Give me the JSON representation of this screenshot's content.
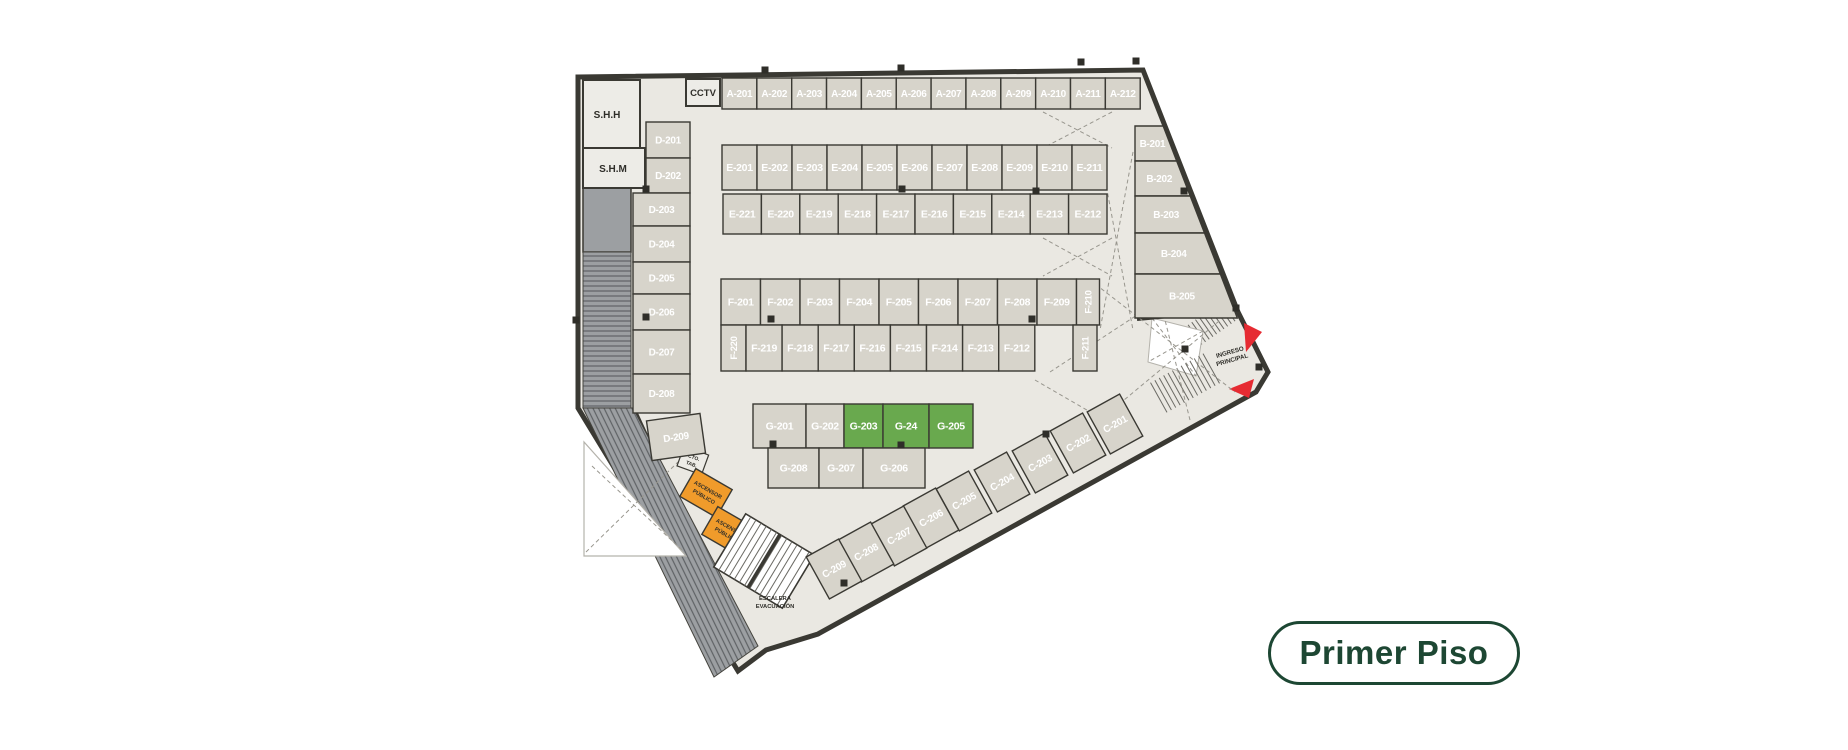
{
  "badge": {
    "label": "Primer Piso"
  },
  "colors": {
    "floor": "#eae8e2",
    "stall": "#d7d4cb",
    "highlight": "#69a94e",
    "wall": "#3a3933",
    "ramp": "#9c9fa2",
    "elevator": "#f09b2b",
    "arrow": "#e62b32",
    "badge_text": "#1d4733"
  },
  "rooms": {
    "shh": "S.H.H",
    "shm": "S.H.M",
    "cctv": "CCTV",
    "cto_line1": "CTO.",
    "cto_line2": "TAB.",
    "elevator_line1": "ASCENSOR",
    "elevator_line2": "PÚBLICO",
    "stair_line1": "ESCALERA",
    "stair_line2": "EVACUACIÓN",
    "entrance_line1": "INGRESO",
    "entrance_line2": "PRINCIPAL"
  },
  "stalls": {
    "a": [
      "A-201",
      "A-202",
      "A-203",
      "A-204",
      "A-205",
      "A-206",
      "A-207",
      "A-208",
      "A-209",
      "A-210",
      "A-211",
      "A-212"
    ],
    "e_top": [
      "E-201",
      "E-202",
      "E-203",
      "E-204",
      "E-205",
      "E-206",
      "E-207",
      "E-208",
      "E-209",
      "E-210",
      "E-211"
    ],
    "e_bottom": [
      "E-221",
      "E-220",
      "E-219",
      "E-218",
      "E-217",
      "E-216",
      "E-215",
      "E-214",
      "E-213",
      "E-212"
    ],
    "f_top": [
      "F-201",
      "F-202",
      "F-203",
      "F-204",
      "F-205",
      "F-206",
      "F-207",
      "F-208",
      "F-209",
      "F-210"
    ],
    "f_bottom": [
      "F-220",
      "F-219",
      "F-218",
      "F-217",
      "F-216",
      "F-215",
      "F-214",
      "F-213",
      "F-212",
      "F-211"
    ],
    "g_top": [
      "G-201",
      "G-202",
      "G-203",
      "G-24",
      "G-205"
    ],
    "g_bottom": [
      "G-208",
      "G-207",
      "G-206"
    ],
    "b": [
      "B-201",
      "B-202",
      "B-203",
      "B-204",
      "B-205"
    ],
    "c": [
      "C-201",
      "C-202",
      "C-203",
      "C-204",
      "C-205",
      "C-206",
      "C-207",
      "C-208",
      "C-209"
    ],
    "d": [
      "D-201",
      "D-202",
      "D-203",
      "D-204",
      "D-205",
      "D-206",
      "D-207",
      "D-208",
      "D-209"
    ]
  },
  "highlighted_stalls": [
    "G-203",
    "G-24",
    "G-205"
  ]
}
